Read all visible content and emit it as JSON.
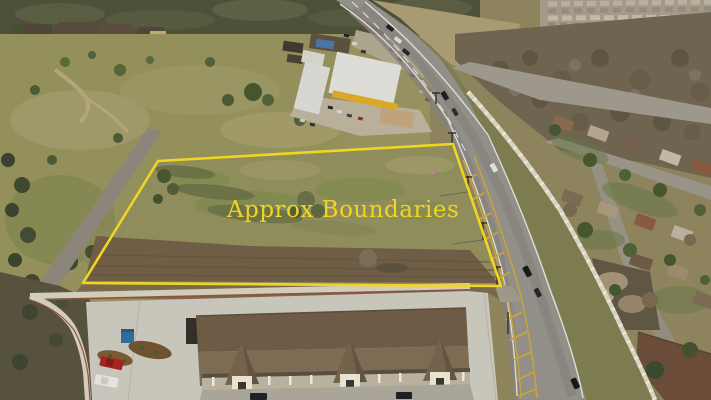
{
  "scene": {
    "description": "Aerial drone photograph of a vacant land parcel outlined in yellow and captioned 'Approx Boundaries'. A two-lane highway with a yellow-striped center turn lane runs diagonally on the right, commercial buildings sit at the top, a residential neighborhood lies behind a white masonry wall to the right, open green fields extend to the left, and a large brown-roofed commercial building with a concrete parking lot fills the foreground."
  },
  "annotation": {
    "label": "Approx Boundaries",
    "color": "#F0D524",
    "polygon_points": "158,161 453,144 501,286 83,283",
    "stroke_width": 2.6
  },
  "palette": {
    "boundary_yellow": "#F0D524",
    "field_olive": "#93905C",
    "parcel_dirt": "#6F5E45",
    "asphalt_gray": "#918F87",
    "median_yellow": "#C8A23C",
    "concrete_light": "#C8C5BB",
    "roof_brown": "#7E6B53",
    "masonry_wall": "#D2CCBA",
    "tree_green": "#4C5836",
    "bare_tree_gray": "#6F6450"
  }
}
